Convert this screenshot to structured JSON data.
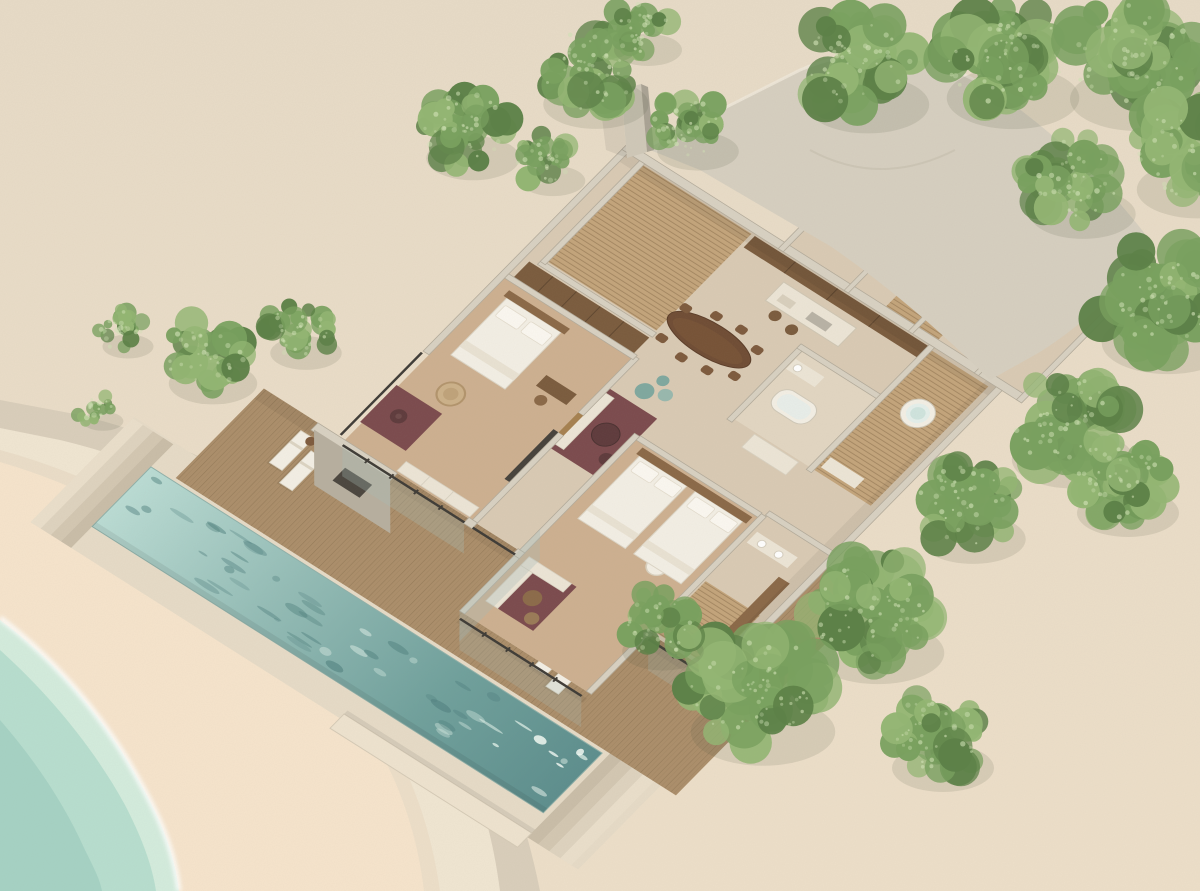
{
  "meta": {
    "description": "Aerial axonometric 3D cutaway rendering of a beachfront two-bedroom pool villa surrounded by trees and sand",
    "visible_text": []
  },
  "colors": {
    "sandTop": "#e7dbc7",
    "sandBottom": "#eddfc9",
    "sandPink": "#f6e4cc",
    "sandShade": "#d9cebb",
    "pathLight": "#f0e6d2",
    "ocean": "#b7decf",
    "oceanShallow": "#d3ecdd",
    "oceanDeep": "#a5d2c4",
    "foam": "#ffffff",
    "poolSurround": "#e6dbc7",
    "poolLight": "#badcd4",
    "poolMid": "#93bcb6",
    "poolDeep": "#6fa09c",
    "poolDark": "#5c8e8d",
    "rippleDark": "#4e7f7e",
    "rippleLight": "#d9ece4",
    "deckWood": "#ab8e6a",
    "deckLine": "#846a4c",
    "wallTop": "#d8d1c2",
    "wallShade": "#b3ab9b",
    "roofSlab": "#d6cfc0",
    "roofEdge": "#efe8d9",
    "concreteBright": "#ece5d6",
    "floorWood": "#cdb090",
    "floorPlaster": "#d9cab4",
    "bathStone": "#e2d6c2",
    "slatWood": "#c3a47b",
    "slatLine": "#9a7d58",
    "woodDark": "#7a5b3d",
    "woodMid": "#8a6847",
    "doorWood": "#a5804f",
    "tableWood": "#6f4c34",
    "seatWood": "#7d5a3d",
    "rugMaroon": "#7b4a4d",
    "rugDark": "#5e3a3c",
    "poufTeal": "#7fa89f",
    "poufTeal2": "#98b8ae",
    "bedWhite": "#f3efe5",
    "bedEdge": "#dcd5c6",
    "pillow": "#fbf8f1",
    "cream": "#ece5d6",
    "glassFrame": "#3e3b36",
    "glassTint": "#a9bcb6",
    "tvDark": "#45413b",
    "chimneyFront": "#cfc8b8",
    "chimneySide": "#a9a294",
    "treeDark": "#5d8148",
    "treeMid": "#79a05f",
    "treeLight": "#93b573",
    "treeSpeck": "#cfe0b4",
    "treeShadowC": "#4c5840"
  },
  "scene": {
    "pool": {
      "ripples": 54,
      "seed": 7
    },
    "trees": [
      {
        "x": 465,
        "y": 128,
        "r": 55
      },
      {
        "x": 588,
        "y": 70,
        "r": 62
      },
      {
        "x": 690,
        "y": 125,
        "r": 48
      },
      {
        "x": 545,
        "y": 160,
        "r": 38
      },
      {
        "x": 640,
        "y": 28,
        "r": 40
      },
      {
        "x": 860,
        "y": 65,
        "r": 72
      },
      {
        "x": 1005,
        "y": 55,
        "r": 78
      },
      {
        "x": 1130,
        "y": 55,
        "r": 80
      },
      {
        "x": 1190,
        "y": 150,
        "r": 72
      },
      {
        "x": 1075,
        "y": 180,
        "r": 62
      },
      {
        "x": 1160,
        "y": 300,
        "r": 78
      },
      {
        "x": 1065,
        "y": 420,
        "r": 72
      },
      {
        "x": 965,
        "y": 505,
        "r": 62
      },
      {
        "x": 1120,
        "y": 480,
        "r": 60
      },
      {
        "x": 870,
        "y": 610,
        "r": 78
      },
      {
        "x": 755,
        "y": 685,
        "r": 85
      },
      {
        "x": 655,
        "y": 625,
        "r": 48
      },
      {
        "x": 935,
        "y": 735,
        "r": 60
      },
      {
        "x": 205,
        "y": 355,
        "r": 52
      },
      {
        "x": 298,
        "y": 330,
        "r": 42
      },
      {
        "x": 120,
        "y": 330,
        "r": 30
      },
      {
        "x": 95,
        "y": 408,
        "r": 24
      }
    ],
    "rooms": [
      "bedroom-1",
      "dressing-court",
      "lounge",
      "bedroom-2-wing",
      "ensuite-2",
      "dining-area",
      "kitchen",
      "bathroom-2",
      "spa-court",
      "annex-rooms"
    ],
    "furniture": [
      "king-bed",
      "twin-beds",
      "hanging-chair",
      "desk-and-chair",
      "window-bench",
      "maroon-rugs",
      "round-coffee-tables",
      "teal-poufs",
      "corner-sofa",
      "wicker-stools",
      "oval-dining-table-8-chairs",
      "kitchen-island-bar-stools",
      "freestanding-bathtub",
      "round-spa-tub",
      "sun-loungers",
      "side-tables"
    ]
  }
}
